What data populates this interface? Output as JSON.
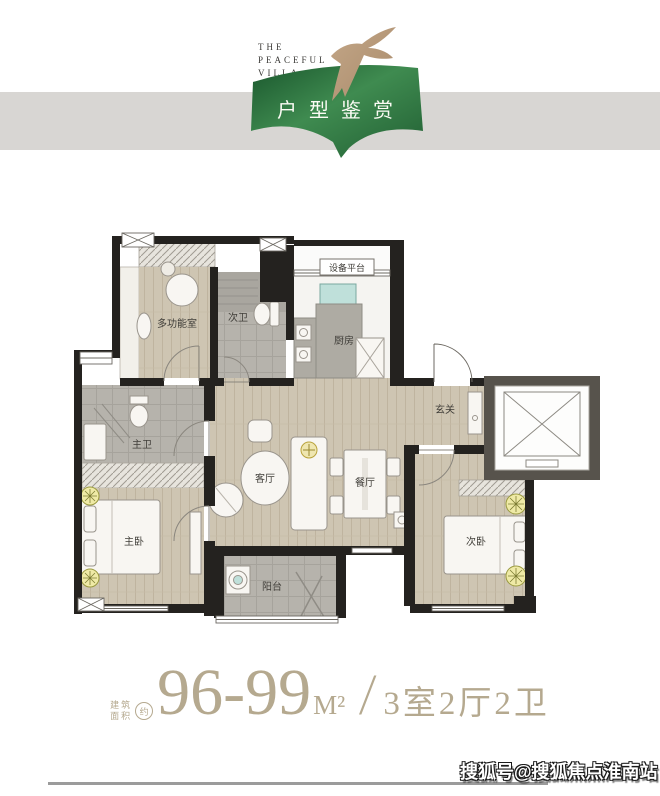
{
  "header": {
    "brand_line1": "THE",
    "brand_line2": "PEACEFUL",
    "brand_line3": "VILLA",
    "banner_title": "户型鉴赏",
    "banner_green": "#2e7a42",
    "band_gray": "#d8d6d3",
    "bird_tan": "#b49678"
  },
  "plan": {
    "rooms": {
      "multi": "多功能室",
      "bath2": "次卫",
      "platform": "设备平台",
      "kitchen": "厨房",
      "foyer": "玄关",
      "bath1": "主卫",
      "living": "客厅",
      "dining": "餐厅",
      "master": "主卧",
      "balcony": "阳台",
      "bed2": "次卧"
    },
    "colors": {
      "wood_floor": "#cec5b2",
      "tile_floor": "#b6b3ac",
      "wall": "#24221f",
      "elevator_wall": "#57534c"
    }
  },
  "footer": {
    "area_label_top": "建筑",
    "area_label_bottom": "面积",
    "approx": "约",
    "area_value": "96-99",
    "area_unit": "M²",
    "divider": "/",
    "layout": "3室2厅2卫",
    "text_color": "#b5a98f"
  },
  "watermark": {
    "text": "搜狐号@搜狐焦点淮南站"
  }
}
